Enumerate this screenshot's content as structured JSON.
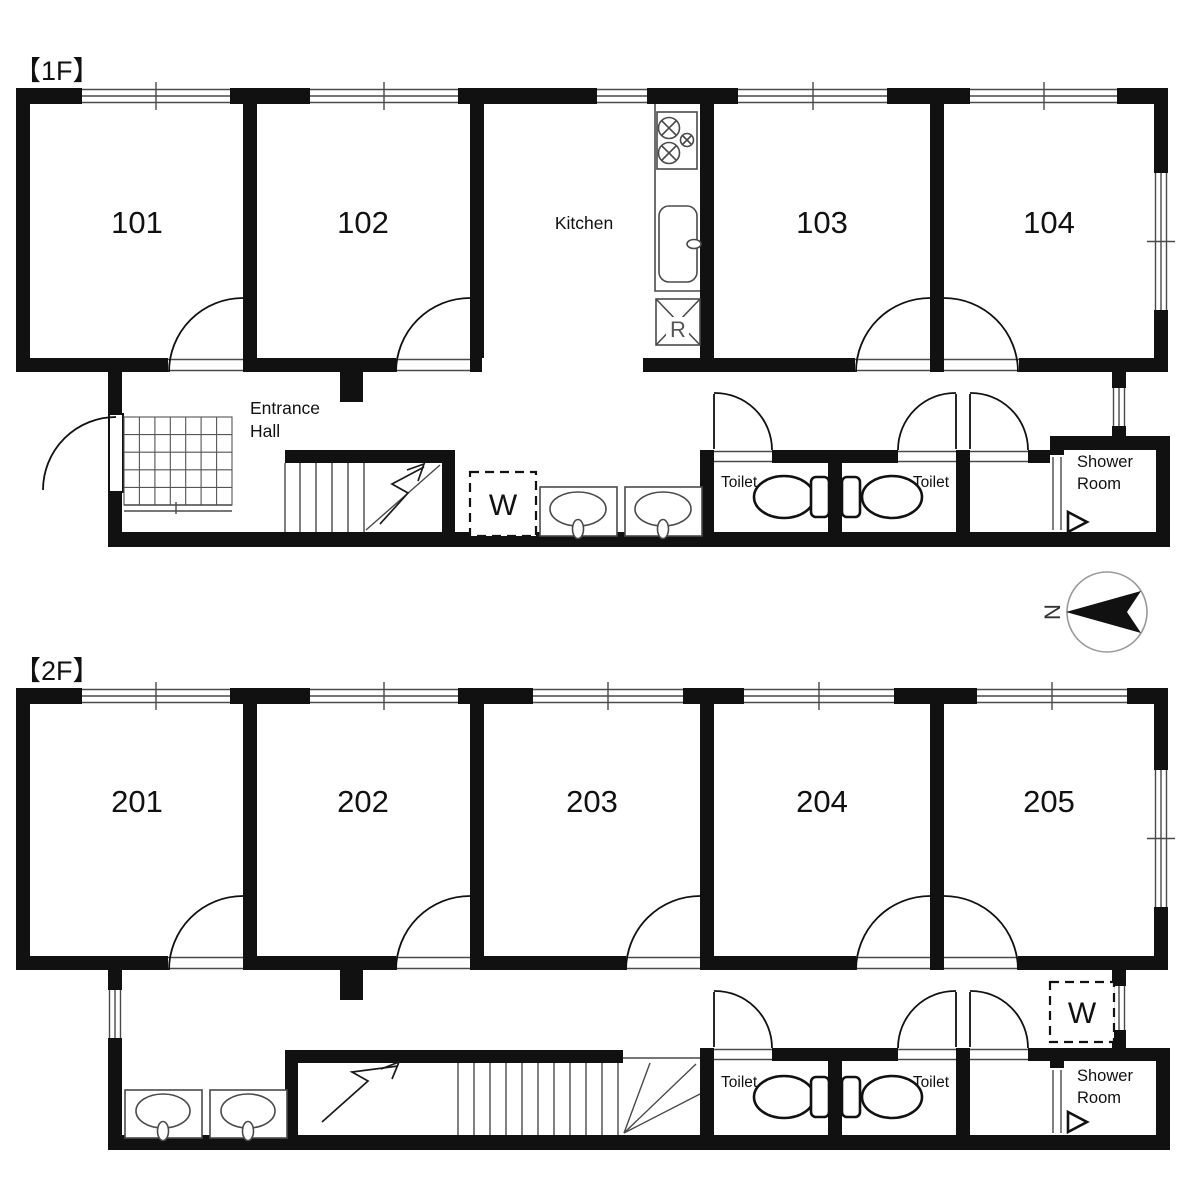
{
  "document": {
    "type": "building-floor-plan",
    "background": "#ffffff"
  },
  "colors": {
    "wall": "#111111",
    "line": "#1a1a1a",
    "fixture_outline": "#4a4a4a",
    "compass_ring": "#9a9a9a",
    "fridge_letter": "#555555"
  },
  "floor1": {
    "label": "【1F】",
    "room_labels": [
      "101",
      "102",
      "103",
      "104"
    ],
    "kitchen_label": "Kitchen",
    "entrance_hall_line1": "Entrance",
    "entrance_hall_line2": "Hall",
    "toilet_label_1": "Toilet",
    "toilet_label_2": "Toilet",
    "shower_line1": "Shower",
    "shower_line2": "Room",
    "washer_label": "W",
    "fridge_label": "R"
  },
  "floor2": {
    "label": "【2F】",
    "room_labels": [
      "201",
      "202",
      "203",
      "204",
      "205"
    ],
    "toilet_label_1": "Toilet",
    "toilet_label_2": "Toilet",
    "shower_line1": "Shower",
    "shower_line2": "Room",
    "washer_label": "W"
  },
  "compass": {
    "north_label": "N"
  }
}
